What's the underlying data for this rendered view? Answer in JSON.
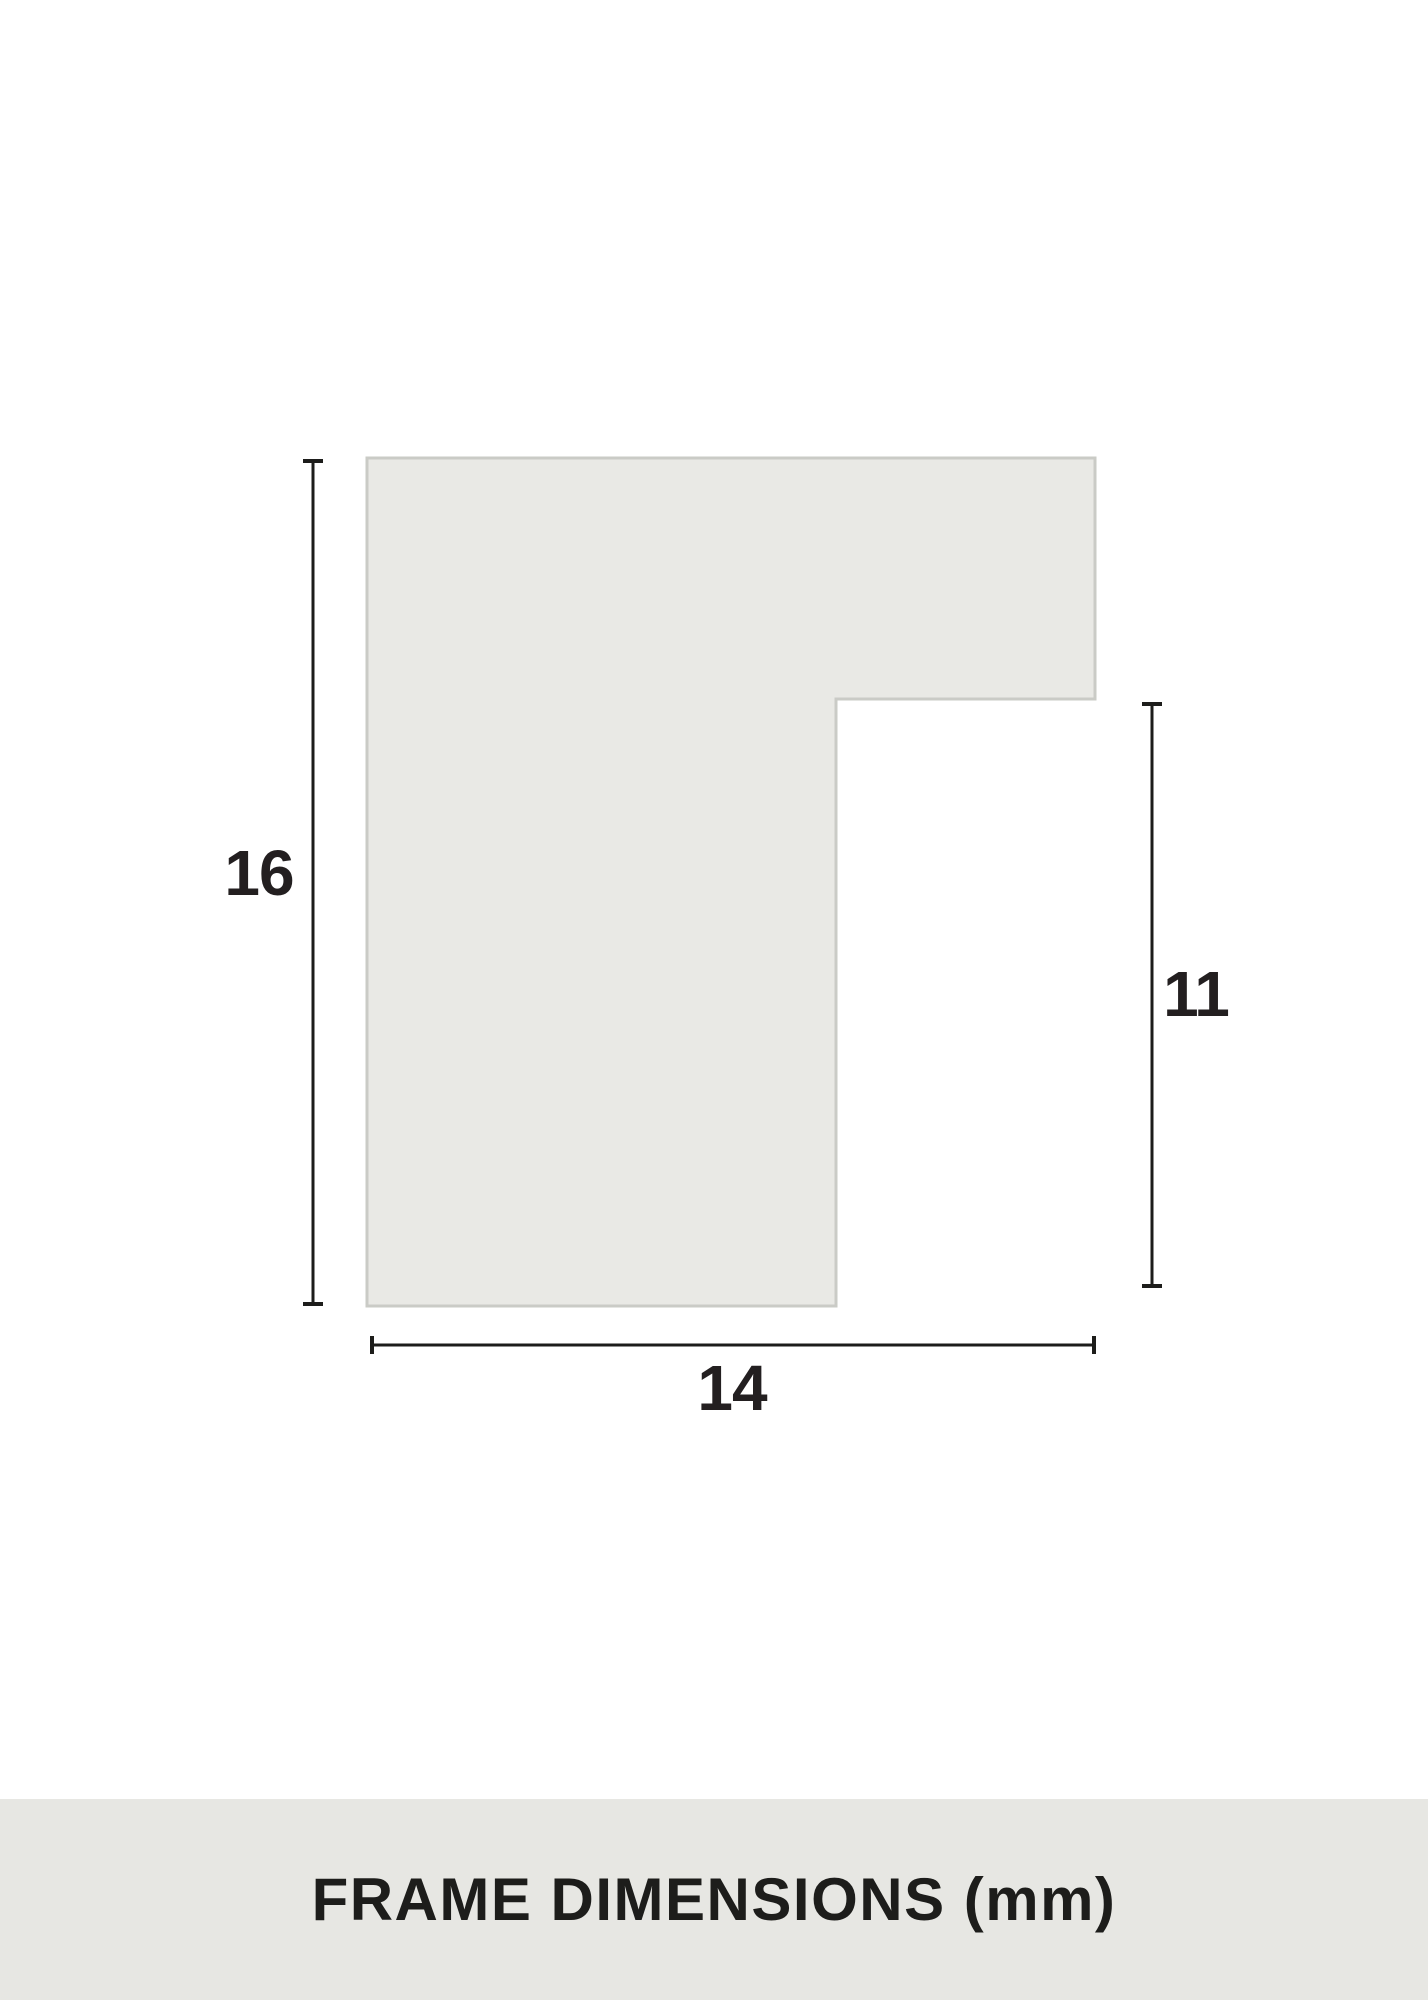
{
  "page": {
    "background": "#ffffff"
  },
  "profile": {
    "description": "frame-moulding-cross-section",
    "fill": "#e9e9e5",
    "border": "#cacbc6"
  },
  "dimensions": {
    "line_color": "#1d1d1b",
    "height_mm": "16",
    "rabbet_depth_mm": "11",
    "width_mm": "14",
    "unit": "mm"
  },
  "footer": {
    "background": "#e7e7e3",
    "title": "FRAME DIMENSIONS (mm)",
    "text_color": "#1d1d1b"
  }
}
